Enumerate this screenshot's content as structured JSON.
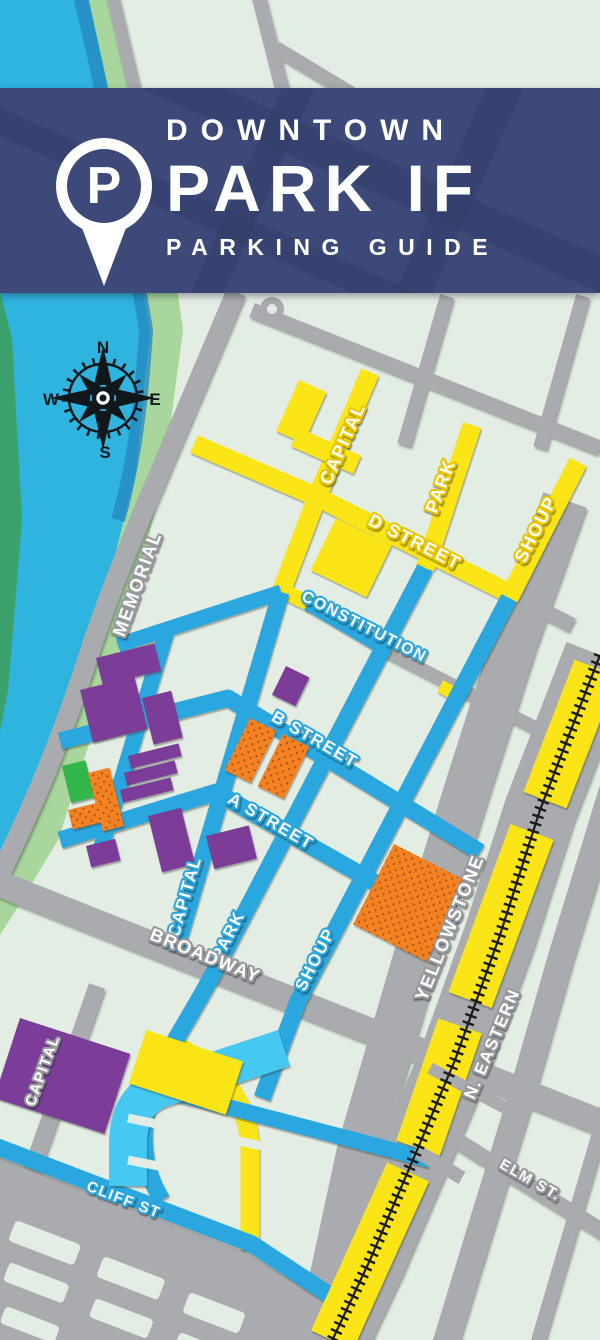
{
  "header": {
    "kicker": "DOWNTOWN",
    "title": "PARK IF",
    "subtitle": "PARKING GUIDE",
    "pin_letter": "P"
  },
  "compass": {
    "north": "N",
    "east": "E",
    "south": "S",
    "west": "W"
  },
  "street_labels": {
    "capital_upper": "CAPITAL",
    "park_upper": "PARK",
    "shoup_upper": "SHOUP",
    "d_street": "D STREET",
    "constitution": "CONSTITUTION",
    "b_street": "B STREET",
    "a_street": "A STREET",
    "capital_lower": "CAPITAL",
    "park_lower": "PARK",
    "shoup_lower": "SHOUP",
    "broadway": "BROADWAY",
    "memorial": "MEMORIAL",
    "yellowstone": "YELLOWSTONE",
    "n_eastern": "N. EASTERN",
    "elm": "ELM ST.",
    "cliff": "CLIFF ST",
    "capital_sw": "CAPITAL"
  },
  "colors": {
    "header_navy": "#3C4979",
    "river_cyan": "#2FB3DF",
    "bank_green": "#A8D69C",
    "block_pale": "#E4EDE4",
    "street_gray": "#A9ABAE",
    "street_yellow": "#FCE516",
    "street_blue": "#2AA7DE",
    "lot_cyan": "#45C8F1",
    "lot_purple": "#7C3C99",
    "lot_orange": "#F58220",
    "lot_green": "#33B54A",
    "railroad_black": "#1B1B1B"
  }
}
